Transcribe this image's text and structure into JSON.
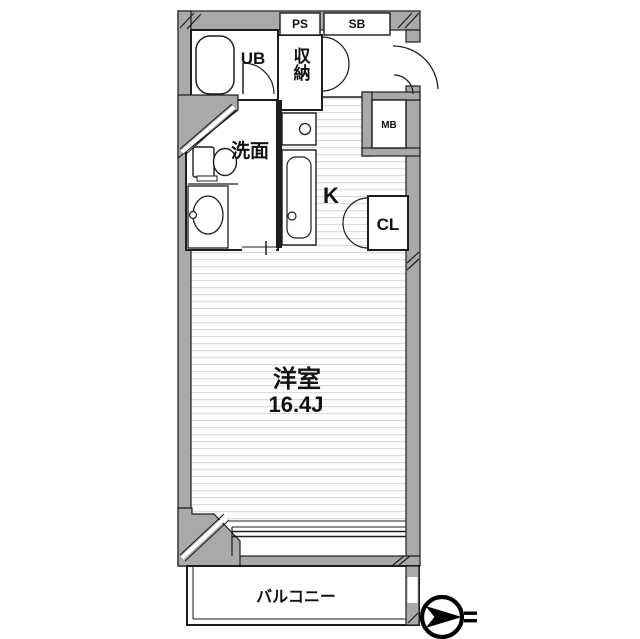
{
  "plan": {
    "type": "apartment-floor-plan",
    "rooms": {
      "unit_bath": {
        "label": "UB"
      },
      "storage": {
        "label": "収納"
      },
      "pipe_space": {
        "label": "PS"
      },
      "shoe_box": {
        "label": "SB"
      },
      "meter_box": {
        "label": "MB"
      },
      "washroom": {
        "label": "洗面"
      },
      "kitchen": {
        "label": "K"
      },
      "closet": {
        "label": "CL"
      },
      "main_room": {
        "label": "洋室",
        "size": "16.4J"
      },
      "balcony": {
        "label": "バルコニー"
      }
    },
    "colors": {
      "wall": "#a9a9a9",
      "line": "#1d1d1d",
      "floor_stripe": "#dcdcdc",
      "background": "#ffffff"
    },
    "compass": {
      "meaning": "north-arrow pointing right"
    }
  }
}
